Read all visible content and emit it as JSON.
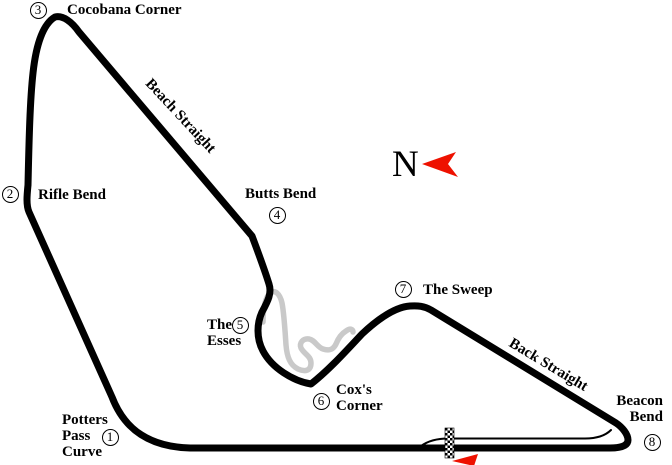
{
  "map": {
    "type": "race-circuit-diagram",
    "compass": {
      "label": "N"
    },
    "corners": [
      {
        "number": "1",
        "name": "Potters Pass Curve"
      },
      {
        "number": "2",
        "name": "Rifle Bend"
      },
      {
        "number": "3",
        "name": "Cocobana Corner"
      },
      {
        "number": "4",
        "name": "Butts Bend"
      },
      {
        "number": "5",
        "name": "The Esses"
      },
      {
        "number": "6",
        "name": "Cox's Corner"
      },
      {
        "number": "7",
        "name": "The Sweep"
      },
      {
        "number": "8",
        "name": "Beacon Bend"
      }
    ],
    "straights": [
      {
        "name": "Beach Straight"
      },
      {
        "name": "Back Straight"
      }
    ]
  },
  "colors": {
    "track": "#000000",
    "alt_route": "#c9c9c9",
    "accent_red": "#ee1100",
    "background": "#ffffff"
  }
}
